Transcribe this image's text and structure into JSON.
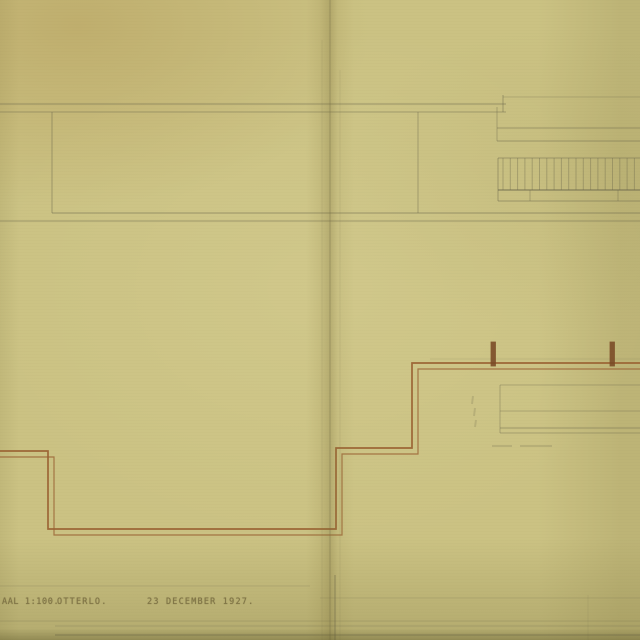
{
  "caption": {
    "scale": "AAL 1:100.",
    "place": "OTTERLO.",
    "date": "23 DECEMBER 1927."
  },
  "colors": {
    "paper": "#cbc283",
    "pencil": "#6e6a4d",
    "ink": "#9a6233",
    "ink_dark": "#7a4a26"
  },
  "drawing": {
    "pencil_lines": [
      {
        "x1": 0,
        "y1": 104,
        "x2": 506,
        "y2": 104,
        "o": 0.55
      },
      {
        "x1": 0,
        "y1": 112,
        "x2": 506,
        "y2": 112,
        "o": 0.45
      },
      {
        "x1": 503,
        "y1": 95,
        "x2": 503,
        "y2": 112,
        "o": 0.5
      },
      {
        "x1": 503,
        "y1": 97,
        "x2": 640,
        "y2": 97,
        "o": 0.28
      },
      {
        "x1": 497,
        "y1": 107,
        "x2": 497,
        "y2": 141,
        "o": 0.4
      },
      {
        "x1": 52,
        "y1": 112,
        "x2": 52,
        "y2": 213,
        "o": 0.5
      },
      {
        "x1": 418,
        "y1": 112,
        "x2": 418,
        "y2": 213,
        "o": 0.45
      },
      {
        "x1": 52,
        "y1": 213,
        "x2": 640,
        "y2": 213,
        "o": 0.55
      },
      {
        "x1": 0,
        "y1": 221,
        "x2": 640,
        "y2": 221,
        "o": 0.5
      },
      {
        "x1": 497,
        "y1": 128,
        "x2": 640,
        "y2": 128,
        "o": 0.5
      },
      {
        "x1": 497,
        "y1": 141,
        "x2": 640,
        "y2": 141,
        "o": 0.5
      },
      {
        "x1": 498,
        "y1": 158,
        "x2": 640,
        "y2": 158,
        "o": 0.5
      },
      {
        "x1": 498,
        "y1": 190,
        "x2": 640,
        "y2": 190,
        "o": 0.6,
        "w": 1.4
      },
      {
        "x1": 498,
        "y1": 201,
        "x2": 640,
        "y2": 201,
        "o": 0.5
      },
      {
        "x1": 498,
        "y1": 158,
        "x2": 498,
        "y2": 201,
        "o": 0.5
      },
      {
        "x1": 530,
        "y1": 190,
        "x2": 530,
        "y2": 201,
        "o": 0.4
      },
      {
        "x1": 618,
        "y1": 190,
        "x2": 618,
        "y2": 201,
        "o": 0.4
      },
      {
        "x1": 500,
        "y1": 385,
        "x2": 640,
        "y2": 385,
        "o": 0.35
      },
      {
        "x1": 500,
        "y1": 411,
        "x2": 640,
        "y2": 411,
        "o": 0.35
      },
      {
        "x1": 500,
        "y1": 428,
        "x2": 640,
        "y2": 428,
        "o": 0.5
      },
      {
        "x1": 500,
        "y1": 433,
        "x2": 640,
        "y2": 433,
        "o": 0.4
      },
      {
        "x1": 500,
        "y1": 385,
        "x2": 500,
        "y2": 433,
        "o": 0.4
      },
      {
        "x1": 430,
        "y1": 359,
        "x2": 640,
        "y2": 359,
        "o": 0.16
      },
      {
        "x1": 330,
        "y1": 0,
        "x2": 330,
        "y2": 640,
        "o": 0.26,
        "w": 1.5
      },
      {
        "x1": 322,
        "y1": 40,
        "x2": 322,
        "y2": 640,
        "o": 0.12
      },
      {
        "x1": 340,
        "y1": 70,
        "x2": 340,
        "y2": 640,
        "o": 0.12
      },
      {
        "x1": 335,
        "y1": 575,
        "x2": 335,
        "y2": 640,
        "o": 0.3,
        "w": 2
      },
      {
        "x1": 0,
        "y1": 586,
        "x2": 310,
        "y2": 586,
        "o": 0.2
      },
      {
        "x1": 320,
        "y1": 598,
        "x2": 640,
        "y2": 598,
        "o": 0.18
      },
      {
        "x1": 0,
        "y1": 621,
        "x2": 640,
        "y2": 621,
        "o": 0.22
      },
      {
        "x1": 55,
        "y1": 626,
        "x2": 640,
        "y2": 626,
        "o": 0.3
      },
      {
        "x1": 55,
        "y1": 635,
        "x2": 640,
        "y2": 635,
        "o": 0.3,
        "w": 2
      },
      {
        "x1": 588,
        "y1": 595,
        "x2": 588,
        "y2": 640,
        "o": 0.12
      }
    ],
    "hatch": {
      "x_start": 503,
      "x_end": 639,
      "y1": 158,
      "y2": 190,
      "step": 7.3,
      "o": 0.4
    },
    "ink_paths": [
      {
        "points": [
          [
            -2,
            451
          ],
          [
            48,
            451
          ],
          [
            48,
            529
          ],
          [
            336,
            529
          ],
          [
            336,
            448
          ],
          [
            412,
            448
          ],
          [
            412,
            363
          ],
          [
            642,
            363
          ]
        ],
        "w": 1.7,
        "o": 0.95
      },
      {
        "points": [
          [
            -2,
            457
          ],
          [
            54,
            457
          ],
          [
            54,
            535
          ],
          [
            342,
            535
          ],
          [
            342,
            454
          ],
          [
            418,
            454
          ],
          [
            418,
            369
          ],
          [
            642,
            369
          ]
        ],
        "w": 1.2,
        "o": 0.8
      }
    ],
    "posts": [
      {
        "x": 491,
        "y": 342,
        "w": 4.5,
        "h": 24
      },
      {
        "x": 610,
        "y": 342,
        "w": 4.5,
        "h": 24
      }
    ],
    "smudges": [
      [
        473,
        396,
        472,
        404
      ],
      [
        475,
        408,
        474,
        416
      ],
      [
        476,
        420,
        475,
        427
      ],
      [
        492,
        446,
        512,
        446
      ],
      [
        520,
        446,
        552,
        446
      ]
    ]
  }
}
